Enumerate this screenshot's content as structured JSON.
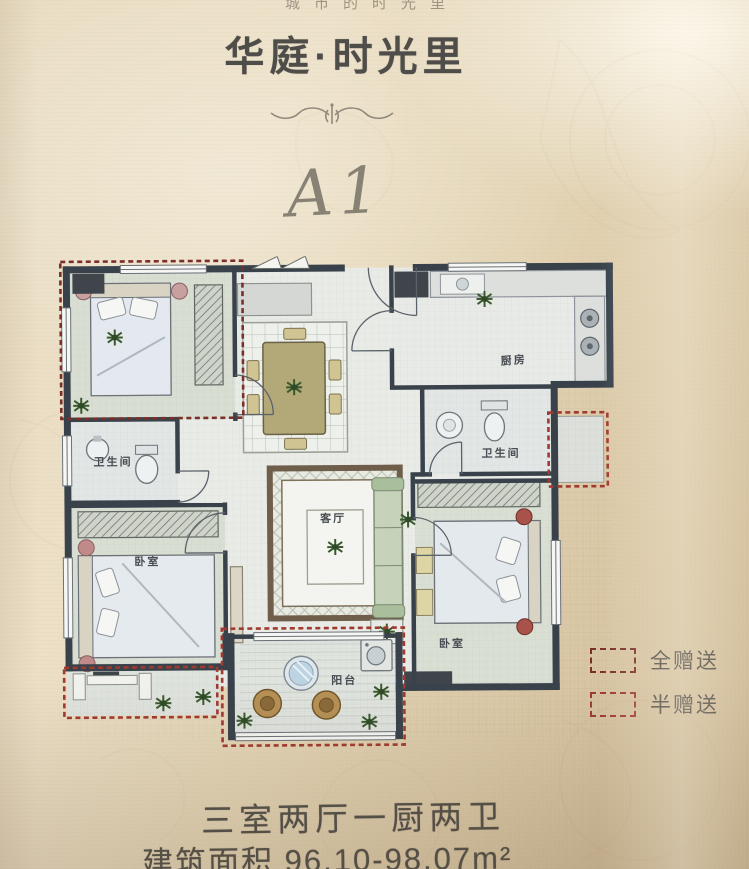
{
  "header": {
    "slogan": "城市的时光里",
    "title": "华庭·时光里",
    "plan_code": "A1"
  },
  "floor_plan": {
    "rooms": {
      "bath_top_left": "卫生间",
      "kitchen": "厨房",
      "bath_right": "卫生间",
      "living": "客厅",
      "bedroom_left": "卧室",
      "bedroom_right": "卧室",
      "balcony": "阳台"
    }
  },
  "legend": {
    "items": [
      {
        "label": "全赠送",
        "color": "#7c2f28"
      },
      {
        "label": "半赠送",
        "color": "#a03a30"
      }
    ]
  },
  "footer": {
    "layout_text": "三室两厅一厨两卫",
    "area_text": "建筑面积 96.10-98.07m²"
  },
  "palette": {
    "paper": "#e3d4b4",
    "wall": "#39424b",
    "gift_dashed_red": "#a03a30",
    "text_dark": "#4f4d49"
  }
}
